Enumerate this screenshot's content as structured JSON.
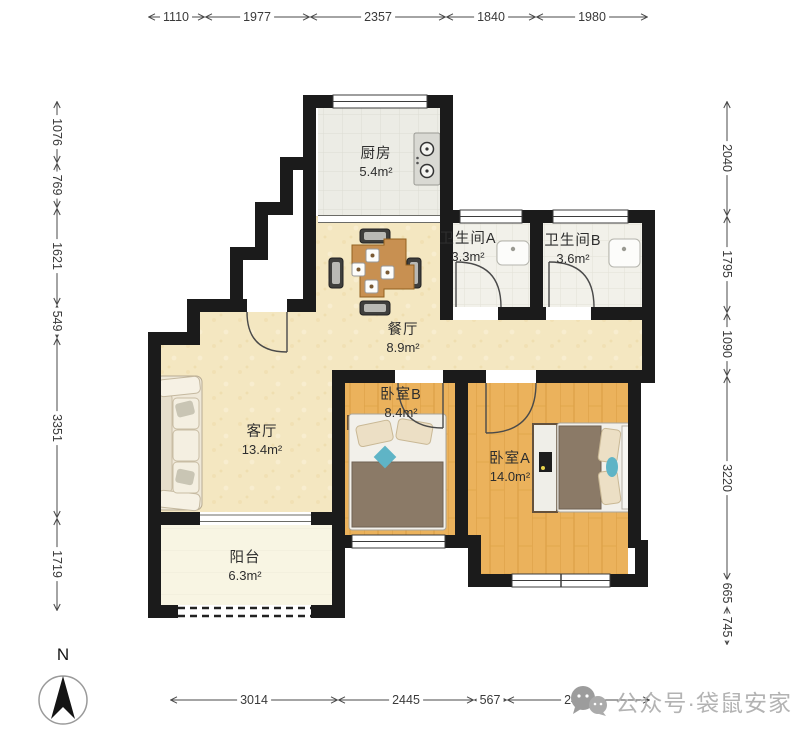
{
  "compass": {
    "label": "N"
  },
  "watermark": {
    "text": "公众号·袋鼠安家",
    "icon": "wechat-bubbles-icon"
  },
  "rooms": [
    {
      "id": "kitchen",
      "name": "厨房",
      "area": "5.4m²"
    },
    {
      "id": "bathroom-a",
      "name": "卫生间A",
      "area": "3.3m²"
    },
    {
      "id": "bathroom-b",
      "name": "卫生间B",
      "area": "3.6m²"
    },
    {
      "id": "dining",
      "name": "餐厅",
      "area": "8.9m²"
    },
    {
      "id": "living",
      "name": "客厅",
      "area": "13.4m²"
    },
    {
      "id": "bedroom-b",
      "name": "卧室B",
      "area": "8.4m²"
    },
    {
      "id": "bedroom-a",
      "name": "卧室A",
      "area": "14.0m²"
    },
    {
      "id": "balcony",
      "name": "阳台",
      "area": "6.3m²"
    }
  ],
  "dimensions": {
    "top": [
      "1110",
      "1977",
      "2357",
      "1840",
      "1980"
    ],
    "left": [
      "1076",
      "769",
      "1621",
      "549",
      "3351",
      "1719"
    ],
    "right": [
      "2040",
      "1795",
      "1090",
      "3220",
      "665",
      "745"
    ],
    "bottom": [
      "3014",
      "2445",
      "567",
      "2459"
    ]
  },
  "palette": {
    "wall": "#1b1b1b",
    "floor_main": "#f4e7c1",
    "floor_bedroom": "#ebb25c",
    "floor_kitchen": "#ededе6",
    "floor_bath": "#f2f1ea",
    "floor_balcony": "#f8f5e3",
    "accent_pillow": "#5fb4c6",
    "blanket": "#8b7a67",
    "dimension_text": "#3a3a3a",
    "watermark_gray": "#b3b3b3"
  }
}
